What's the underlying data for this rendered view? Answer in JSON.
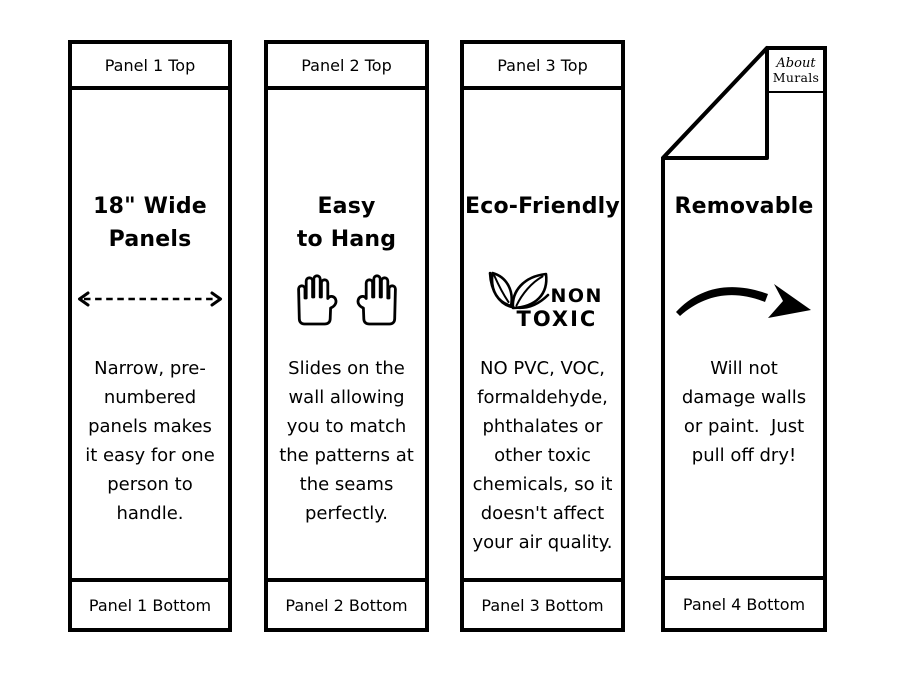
{
  "meta": {
    "background": "#ffffff",
    "ink": "#000000"
  },
  "brand": {
    "logo_line1": "About",
    "logo_line2": "Murals"
  },
  "panels": [
    {
      "top_label": "Panel 1 Top",
      "bottom_label": "Panel 1 Bottom",
      "title_lines": [
        "18\" Wide",
        "Panels"
      ],
      "icon": "dashed-width-arrow",
      "body_lines": [
        "Narrow, pre-",
        "numbered",
        "panels makes",
        "it easy for one",
        "person to",
        "handle."
      ]
    },
    {
      "top_label": "Panel 2 Top",
      "bottom_label": "Panel 2 Bottom",
      "title_lines": [
        "Easy",
        "to Hang"
      ],
      "icon": "two-raised-hands",
      "body_lines": [
        "Slides on the",
        "wall allowing",
        "you to match",
        "the patterns at",
        "the seams",
        "perfectly."
      ]
    },
    {
      "top_label": "Panel 3 Top",
      "bottom_label": "Panel 3 Bottom",
      "title_lines": [
        "Eco-Friendly"
      ],
      "icon": "non-toxic-leaves",
      "icon_text_lines": [
        "NON",
        "TOXIC"
      ],
      "body_lines": [
        "NO PVC, VOC,",
        "formaldehyde,",
        "phthalates or",
        "other toxic",
        "chemicals, so it",
        "doesn't affect",
        "your air quality."
      ]
    },
    {
      "bottom_label": "Panel 4 Bottom",
      "title_lines": [
        "Removable"
      ],
      "icon": "curved-removal-arrow",
      "body_lines": [
        "Will not",
        "damage walls",
        "or paint.  Just",
        "pull off dry!"
      ]
    }
  ]
}
